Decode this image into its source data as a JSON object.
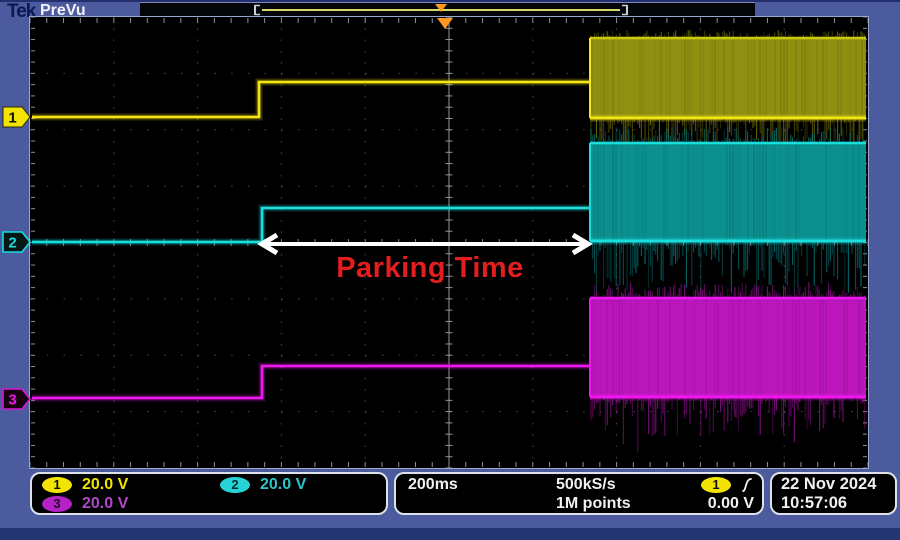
{
  "header": {
    "logo_text": "Tek",
    "acq_status": "PreVu"
  },
  "annotation": {
    "text": "Parking Time",
    "color": "#e41e1e"
  },
  "channels": [
    {
      "label": "1",
      "scale": "20.0 V",
      "trace_color": "#f5e513"
    },
    {
      "label": "2",
      "scale": "20.0 V",
      "trace_color": "#18dede"
    },
    {
      "label": "3",
      "scale": "20.0 V",
      "trace_color": "#ee18ee"
    }
  ],
  "statusbar": {
    "timebase": "200ms",
    "sample_rate": "500kS/s",
    "record_length": "1M points",
    "trigger_source": "1",
    "trigger_slope": "rising-edge",
    "trigger_level": "0.00 V",
    "date": "22 Nov 2024",
    "time": "10:57:06"
  },
  "chart_data": {
    "type": "line",
    "x_axis": {
      "time_per_div": "200ms",
      "divisions": 10
    },
    "y_axis": {
      "divisions": 8,
      "scale_per_div": "20.0 V"
    },
    "series": [
      {
        "name": "CH1",
        "color": "#f5e513",
        "segments": [
          {
            "from_div": 0,
            "to_div": 2.75,
            "state": "flat baseline"
          },
          {
            "from_div": 2.75,
            "to_div": 6.7,
            "state": "flat, stepped up ~0.6 div"
          },
          {
            "from_div": 6.7,
            "to_div": 10,
            "state": "PWM switching band ~1.4 div tall above baseline"
          }
        ]
      },
      {
        "name": "CH2",
        "color": "#18dede",
        "segments": [
          {
            "from_div": 0,
            "to_div": 2.77,
            "state": "flat baseline (center graticule)"
          },
          {
            "from_div": 2.77,
            "to_div": 6.7,
            "state": "flat, stepped up ~0.6 div"
          },
          {
            "from_div": 6.7,
            "to_div": 10,
            "state": "PWM switching band ~1.75 div tall above baseline"
          }
        ]
      },
      {
        "name": "CH3",
        "color": "#ee18ee",
        "segments": [
          {
            "from_div": 0,
            "to_div": 2.77,
            "state": "flat baseline"
          },
          {
            "from_div": 2.77,
            "to_div": 6.7,
            "state": "flat, stepped up ~0.6 div"
          },
          {
            "from_div": 6.7,
            "to_div": 10,
            "state": "PWM switching band ~1.75 div tall above baseline"
          }
        ]
      }
    ],
    "annotation": {
      "text": "Parking Time",
      "span_div": [
        2.77,
        6.66
      ]
    }
  },
  "waveform_geometry": {
    "plot": {
      "w": 838,
      "h": 451,
      "cols": 10,
      "rows": 8
    },
    "channels": [
      {
        "name": "CH1",
        "trace": "#f5e513",
        "fill": "#8f8f11",
        "top_edge": "#c9c910",
        "noise": "#6f6f06",
        "base_from": 2,
        "baseline": 100,
        "step_x": 229,
        "level": 65,
        "pwm_x": 560,
        "pwm_top": 21,
        "pwm_bottom": 101,
        "end": 836,
        "spike_up": 7,
        "spike_down": 34
      },
      {
        "name": "CH2",
        "trace": "#18dede",
        "fill": "#0c8f8f",
        "top_edge": "#18dede",
        "noise": "#077070",
        "base_from": 2,
        "baseline": 225,
        "step_x": 232,
        "level": 191,
        "pwm_x": 560,
        "pwm_top": 126,
        "pwm_bottom": 224,
        "end": 836,
        "spike_up": 15,
        "spike_down": 54
      },
      {
        "name": "CH3",
        "trace": "#ee18ee",
        "fill": "#bb16bb",
        "top_edge": "#ee18ee",
        "noise": "#8d0f8d",
        "base_from": 2,
        "baseline": 381,
        "step_x": 232,
        "level": 349,
        "pwm_x": 560,
        "pwm_top": 281,
        "pwm_bottom": 380,
        "end": 836,
        "spike_up": 15,
        "spike_down": 38
      }
    ],
    "arrow": {
      "x1": 232,
      "x2": 558,
      "y": 227,
      "color": "#ffffff"
    },
    "trigger_marker": {
      "x": 415,
      "color": "#ff9820"
    },
    "record_view": {
      "bracket_left": 115,
      "bracket_right": 487,
      "line_y": 7,
      "tri_x": 301,
      "line_color": "#d8d868",
      "tri_color": "#ff9820"
    }
  }
}
